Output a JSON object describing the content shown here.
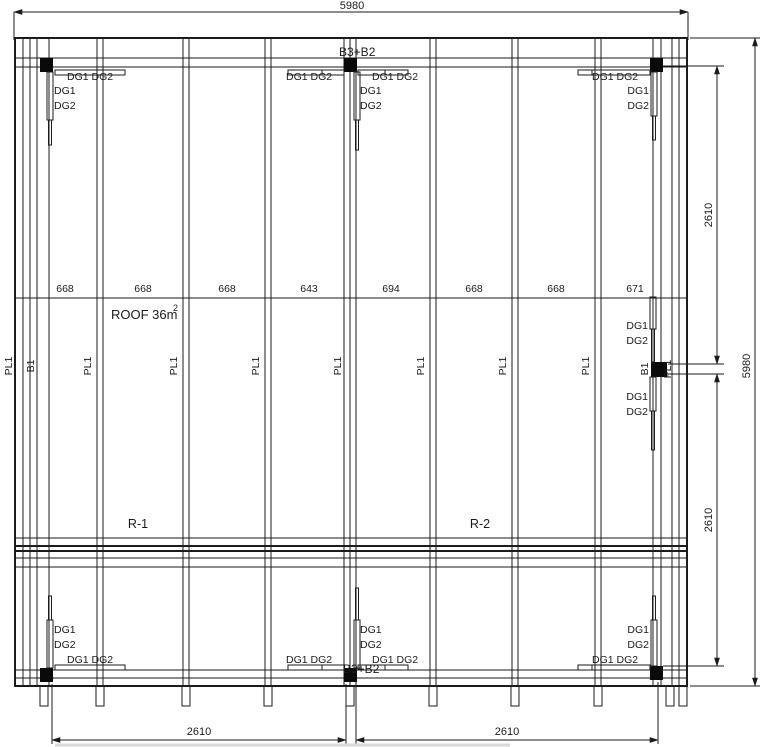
{
  "drawing": {
    "overall_width": "5980",
    "overall_height": "5980",
    "half_height_upper": "2610",
    "half_height_lower": "2610",
    "half_width_left": "2610",
    "half_width_right": "2610",
    "joist_spacings": [
      "668",
      "668",
      "668",
      "643",
      "694",
      "668",
      "668",
      "671"
    ],
    "roof_area": "ROOF 36m",
    "roof_area_exp": "2",
    "region_left": "R-1",
    "region_right": "R-2",
    "beam_combo": "B3+B2",
    "beam": "B1",
    "purlin": "PL1",
    "girder_1": "DG1",
    "girder_2": "DG2",
    "girder_pair": "DG1 DG2",
    "colors": {
      "line": "#1b1b1b",
      "background": "#ffffff"
    }
  }
}
